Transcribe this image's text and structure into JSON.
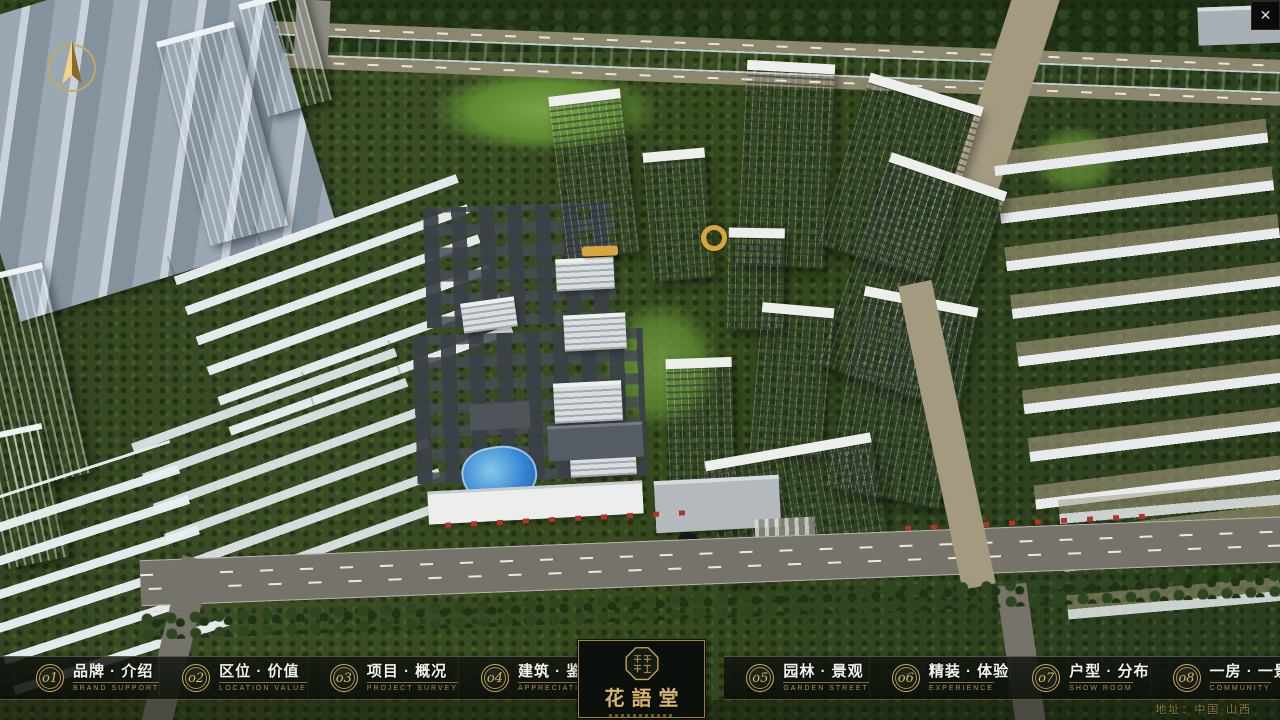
{
  "window": {
    "close_icon": "✕"
  },
  "nav": {
    "items": [
      {
        "num": "o1",
        "title": "品牌 · 介绍",
        "subtitle": "BRAND SUPPORT"
      },
      {
        "num": "o2",
        "title": "区位 · 价值",
        "subtitle": "LOCATION VALUE"
      },
      {
        "num": "o3",
        "title": "项目 · 概况",
        "subtitle": "PROJECT SURVEY"
      },
      {
        "num": "o4",
        "title": "建筑 · 鉴赏",
        "subtitle": "APPRECIATION"
      },
      {
        "num": "o5",
        "title": "园林 · 景观",
        "subtitle": "GARDEN STREET"
      },
      {
        "num": "o6",
        "title": "精装 · 体验",
        "subtitle": "EXPERIENCE"
      },
      {
        "num": "o7",
        "title": "户型 · 分布",
        "subtitle": "SHOW ROOM"
      },
      {
        "num": "o8",
        "title": "一房 · 一景",
        "subtitle": "COMMUNITY"
      }
    ]
  },
  "logo": {
    "title": "花語堂"
  },
  "footer": {
    "address": "地址：中国·山西"
  },
  "colors": {
    "gold": "#c9a85c",
    "river_blue": "#2563c4",
    "bar_bg": "rgba(10,14,10,0.85)"
  }
}
